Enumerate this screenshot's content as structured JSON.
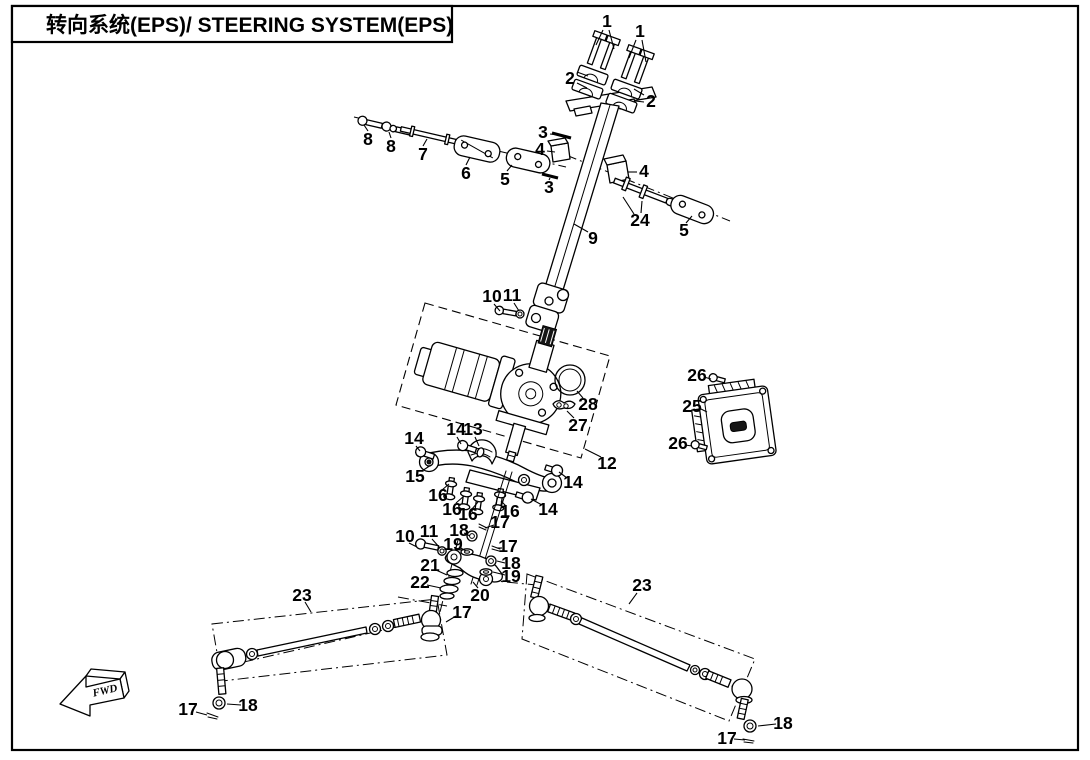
{
  "title": "转向系统(EPS)/ STEERING SYSTEM(EPS)",
  "fwd_label": "FWD",
  "colors": {
    "line": "#000000",
    "background": "#ffffff"
  },
  "callouts": [
    {
      "n": "1",
      "x": 607,
      "y": 21,
      "leaders": [
        [
          603,
          30,
          596,
          45
        ],
        [
          609,
          30,
          614,
          49
        ]
      ]
    },
    {
      "n": "1",
      "x": 640,
      "y": 31,
      "leaders": [
        [
          636,
          40,
          629,
          58
        ],
        [
          642,
          40,
          646,
          62
        ]
      ]
    },
    {
      "n": "2",
      "x": 570,
      "y": 78,
      "leaders": [
        [
          577,
          72,
          588,
          76
        ],
        [
          577,
          83,
          587,
          88
        ]
      ]
    },
    {
      "n": "2",
      "x": 651,
      "y": 101,
      "leaders": [
        [
          644,
          95,
          634,
          89
        ],
        [
          644,
          102,
          635,
          101
        ]
      ]
    },
    {
      "n": "8",
      "x": 368,
      "y": 139,
      "leaders": [
        [
          368,
          131,
          364,
          125
        ]
      ]
    },
    {
      "n": "8",
      "x": 391,
      "y": 146,
      "leaders": [
        [
          391,
          138,
          389,
          132
        ]
      ]
    },
    {
      "n": "7",
      "x": 423,
      "y": 154,
      "leaders": [
        [
          423,
          146,
          427,
          139
        ]
      ]
    },
    {
      "n": "6",
      "x": 466,
      "y": 173,
      "leaders": [
        [
          466,
          165,
          470,
          157
        ]
      ]
    },
    {
      "n": "5",
      "x": 505,
      "y": 179,
      "leaders": [
        [
          507,
          171,
          512,
          165
        ]
      ]
    },
    {
      "n": "3",
      "x": 543,
      "y": 132,
      "leaders": [
        [
          550,
          134,
          559,
          135
        ]
      ]
    },
    {
      "n": "4",
      "x": 540,
      "y": 149,
      "leaders": [
        [
          547,
          151,
          555,
          152
        ]
      ]
    },
    {
      "n": "3",
      "x": 549,
      "y": 187,
      "leaders": [
        [
          549,
          180,
          550,
          178
        ]
      ]
    },
    {
      "n": "9",
      "x": 593,
      "y": 238,
      "leaders": [
        [
          588,
          232,
          574,
          224
        ]
      ]
    },
    {
      "n": "4",
      "x": 644,
      "y": 171,
      "leaders": [
        [
          637,
          172,
          628,
          172
        ]
      ]
    },
    {
      "n": "24",
      "x": 640,
      "y": 220,
      "leaders": [
        [
          634,
          214,
          623,
          197
        ],
        [
          641,
          213,
          642,
          201
        ]
      ]
    },
    {
      "n": "5",
      "x": 684,
      "y": 230,
      "leaders": [
        [
          686,
          223,
          692,
          216
        ]
      ]
    },
    {
      "n": "10",
      "x": 492,
      "y": 296,
      "leaders": [
        [
          494,
          304,
          500,
          311
        ]
      ]
    },
    {
      "n": "11",
      "x": 512,
      "y": 295,
      "leaders": [
        [
          514,
          303,
          519,
          311
        ]
      ]
    },
    {
      "n": "28",
      "x": 588,
      "y": 404,
      "leaders": [
        [
          583,
          398,
          577,
          391
        ]
      ]
    },
    {
      "n": "27",
      "x": 578,
      "y": 425,
      "leaders": [
        [
          574,
          418,
          567,
          411
        ]
      ]
    },
    {
      "n": "12",
      "x": 607,
      "y": 463,
      "leaders": [
        [
          601,
          457,
          585,
          449
        ]
      ]
    },
    {
      "n": "25",
      "x": 692,
      "y": 406,
      "leaders": [
        [
          699,
          408,
          707,
          412
        ]
      ]
    },
    {
      "n": "26",
      "x": 697,
      "y": 375,
      "leaders": [
        [
          704,
          377,
          711,
          379
        ]
      ]
    },
    {
      "n": "26",
      "x": 678,
      "y": 443,
      "leaders": [
        [
          685,
          445,
          692,
          446
        ]
      ]
    },
    {
      "n": "14",
      "x": 456,
      "y": 429,
      "leaders": [
        [
          457,
          437,
          461,
          444
        ]
      ]
    },
    {
      "n": "13",
      "x": 473,
      "y": 429,
      "leaders": [
        [
          475,
          437,
          479,
          446
        ]
      ]
    },
    {
      "n": "14",
      "x": 414,
      "y": 438,
      "leaders": [
        [
          416,
          446,
          420,
          451
        ]
      ]
    },
    {
      "n": "15",
      "x": 415,
      "y": 476,
      "leaders": [
        [
          422,
          471,
          431,
          465
        ]
      ]
    },
    {
      "n": "14",
      "x": 573,
      "y": 482,
      "leaders": [
        [
          567,
          478,
          559,
          472
        ]
      ]
    },
    {
      "n": "14",
      "x": 548,
      "y": 509,
      "leaders": [
        [
          542,
          505,
          531,
          499
        ]
      ]
    },
    {
      "n": "16",
      "x": 438,
      "y": 495,
      "leaders": [
        [
          442,
          490,
          449,
          484
        ]
      ]
    },
    {
      "n": "16",
      "x": 452,
      "y": 509,
      "leaders": [
        [
          456,
          503,
          464,
          496
        ]
      ]
    },
    {
      "n": "16",
      "x": 468,
      "y": 514,
      "leaders": [
        [
          472,
          509,
          478,
          502
        ]
      ]
    },
    {
      "n": "16",
      "x": 510,
      "y": 511,
      "leaders": [
        [
          506,
          506,
          501,
          501
        ]
      ]
    },
    {
      "n": "17",
      "x": 500,
      "y": 522,
      "leaders": [
        [
          494,
          525,
          485,
          528
        ]
      ]
    },
    {
      "n": "18",
      "x": 459,
      "y": 530,
      "leaders": [
        [
          464,
          533,
          470,
          536
        ]
      ]
    },
    {
      "n": "19",
      "x": 453,
      "y": 544,
      "leaders": [
        [
          459,
          547,
          466,
          551
        ]
      ]
    },
    {
      "n": "17",
      "x": 508,
      "y": 546,
      "leaders": [
        [
          502,
          548,
          497,
          548
        ]
      ]
    },
    {
      "n": "18",
      "x": 511,
      "y": 563,
      "leaders": [
        [
          505,
          563,
          497,
          561
        ]
      ]
    },
    {
      "n": "19",
      "x": 511,
      "y": 576,
      "leaders": [
        [
          505,
          575,
          493,
          572
        ]
      ]
    },
    {
      "n": "21",
      "x": 430,
      "y": 565,
      "leaders": [
        [
          436,
          570,
          447,
          575
        ]
      ]
    },
    {
      "n": "22",
      "x": 420,
      "y": 582,
      "leaders": [
        [
          427,
          585,
          441,
          588
        ]
      ]
    },
    {
      "n": "20",
      "x": 480,
      "y": 595,
      "leaders": [
        [
          478,
          588,
          473,
          582
        ]
      ]
    },
    {
      "n": "17",
      "x": 462,
      "y": 612,
      "leaders": [
        [
          456,
          616,
          446,
          622
        ]
      ]
    },
    {
      "n": "10",
      "x": 405,
      "y": 536,
      "leaders": [
        [
          409,
          543,
          417,
          547
        ]
      ]
    },
    {
      "n": "11",
      "x": 429,
      "y": 531,
      "leaders": [
        [
          432,
          539,
          440,
          548
        ]
      ]
    },
    {
      "n": "23",
      "x": 302,
      "y": 595,
      "leaders": [
        [
          305,
          602,
          311,
          612
        ]
      ]
    },
    {
      "n": "23",
      "x": 642,
      "y": 585,
      "leaders": [
        [
          637,
          593,
          629,
          604
        ]
      ]
    },
    {
      "n": "17",
      "x": 188,
      "y": 709,
      "leaders": [
        [
          196,
          712,
          207,
          715
        ]
      ]
    },
    {
      "n": "18",
      "x": 248,
      "y": 705,
      "leaders": [
        [
          241,
          705,
          227,
          704
        ]
      ]
    },
    {
      "n": "18",
      "x": 783,
      "y": 723,
      "leaders": [
        [
          776,
          724,
          758,
          726
        ]
      ]
    },
    {
      "n": "17",
      "x": 727,
      "y": 738,
      "leaders": [
        [
          734,
          739,
          745,
          740
        ]
      ]
    }
  ]
}
